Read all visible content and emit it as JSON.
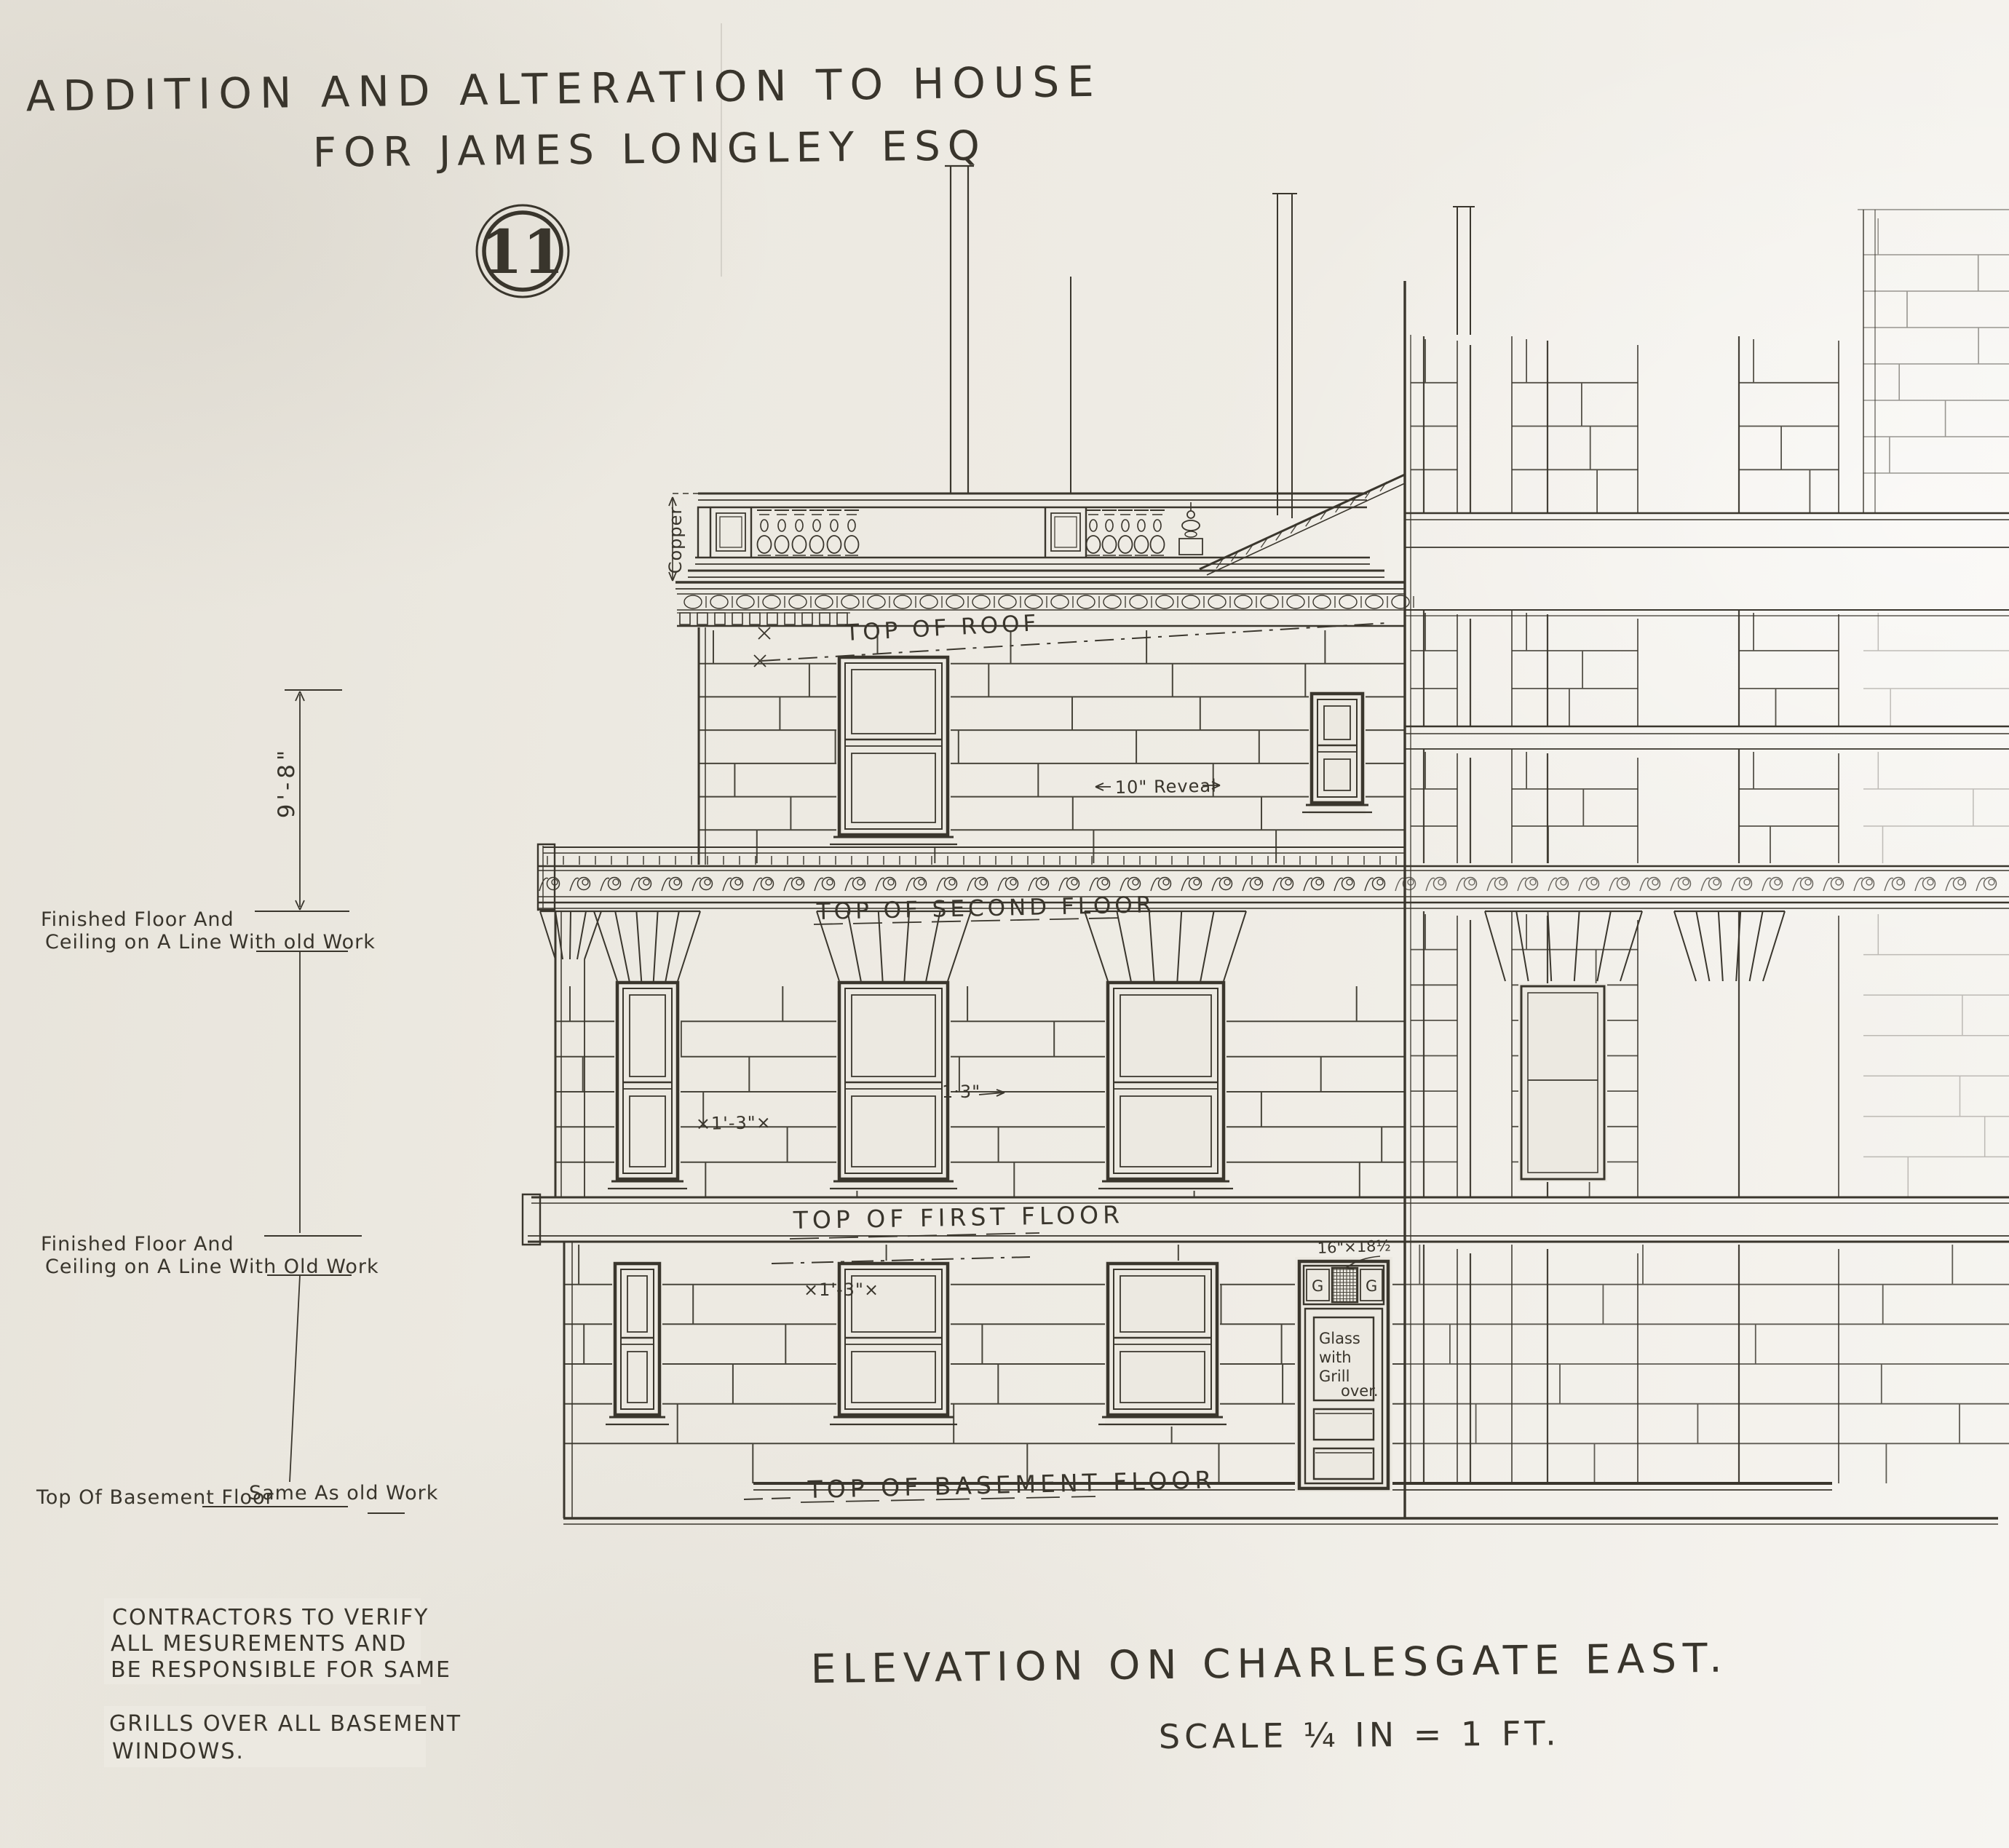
{
  "drawing": {
    "number": "11",
    "title_line1": "ADDITION AND ALTERATION TO HOUSE",
    "title_line2": "FOR JAMES LONGLEY ESQ",
    "view_title": "ELEVATION ON CHARLESGATE EAST.",
    "scale_note": "SCALE ¼ IN = 1 FT."
  },
  "floor_labels": {
    "roof": "TOP OF ROOF",
    "second": "TOP OF SECOND FLOOR",
    "first": "TOP OF FIRST FLOOR",
    "basement": "TOP OF BASEMENT FLOOR"
  },
  "dimensions": {
    "copper": "Copper",
    "height_9_8": "9'-8\"",
    "reveal": "10\" Reveal",
    "dim_1_3_first": "×1'-3\"×",
    "dim_1_3_right": "1·3\"",
    "dim_1_3_basement": "×1'-3\"×",
    "grille_size": "16\"×18½"
  },
  "door": {
    "grill_left": "G",
    "grill_right": "G",
    "glass_note_l1": "Glass",
    "glass_note_l2": "with",
    "glass_note_l3": "Grill",
    "glass_note_l4": "over."
  },
  "margin_notes": {
    "second_l1": "Finished Floor And",
    "second_l2": "Ceiling on A Line With old Work",
    "first_l1": "Finished Floor And",
    "first_l2": "Ceiling on A Line With Old Work",
    "basement_left": "Top Of Basement Floor",
    "basement_right": "Same As old Work"
  },
  "general_notes": {
    "contractors_l1": "CONTRACTORS TO VERIFY",
    "contractors_l2": "ALL MESUREMENTS AND",
    "contractors_l3": "BE RESPONSIBLE FOR SAME",
    "grills_l1": "GRILLS OVER ALL BASEMENT",
    "grills_l2": "WINDOWS."
  },
  "colors": {
    "paper": "#ece9e1",
    "ink": "#3a362d"
  }
}
